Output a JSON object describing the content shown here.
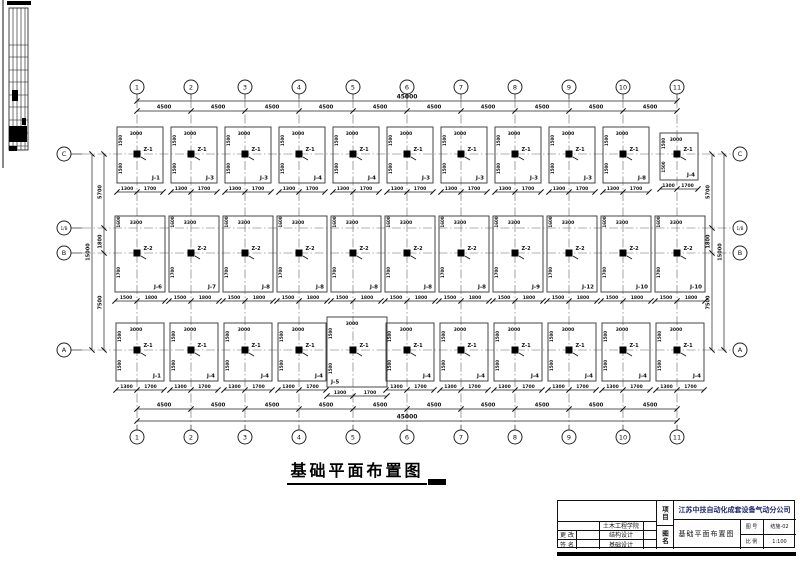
{
  "drawing_title": "基础平面布置图",
  "plan": {
    "grid_cols": [
      "1",
      "2",
      "3",
      "4",
      "5",
      "6",
      "7",
      "8",
      "9",
      "10",
      "11"
    ],
    "grid_rows": [
      "C",
      "1/B",
      "B",
      "A"
    ],
    "dims": {
      "bay": "4500",
      "total": "45000",
      "left_segments": [
        "5700",
        "1800",
        "7500"
      ],
      "left_total": "15000"
    },
    "footing_rows": {
      "row_C": {
        "labels": [
          "J-1",
          "J-3",
          "J-3",
          "J-4",
          "J-4",
          "J-3",
          "J-3",
          "J-3",
          "J-3",
          "J-8",
          "J-4"
        ],
        "col_tag": "Z-1",
        "top_dim": "3000",
        "bottom_dims": [
          "1300",
          "1700"
        ],
        "side_dims": [
          "1500",
          "1500"
        ]
      },
      "row_B": {
        "labels": [
          "J-6",
          "J-7",
          "J-8",
          "J-8",
          "J-8",
          "J-8",
          "J-8",
          "J-9",
          "J-12",
          "J-10",
          "J-10"
        ],
        "col_tag": "Z-2",
        "top_dim": "3300",
        "bottom_dims": [
          "1500",
          "1800"
        ],
        "side_dims": [
          "1600",
          "1700"
        ]
      },
      "row_A": {
        "labels": [
          "J-1",
          "J-4",
          "J-4",
          "J-4",
          "J-5",
          "J-4",
          "J-4",
          "J-4",
          "J-4",
          "J-4",
          "J-4"
        ],
        "col_tag": "Z-1",
        "top_dim": "3000",
        "bottom_dims": [
          "1300",
          "1700"
        ],
        "side_dims": [
          "1500",
          "1500"
        ]
      }
    }
  },
  "titleblock": {
    "school": "土木工程学院",
    "row_change": "更 改",
    "row_sign": "签 名",
    "struct_design": "结构设计",
    "found_design": "基础设计",
    "project_label": "项目",
    "sheet_label": "图名",
    "company": "江苏中技自动化成套设备气动分公司",
    "drawing_name": "基础平面布置图",
    "no_label": "图 号",
    "no_value": "结施-02",
    "scale_label": "比 例",
    "scale_value": "1:100"
  }
}
